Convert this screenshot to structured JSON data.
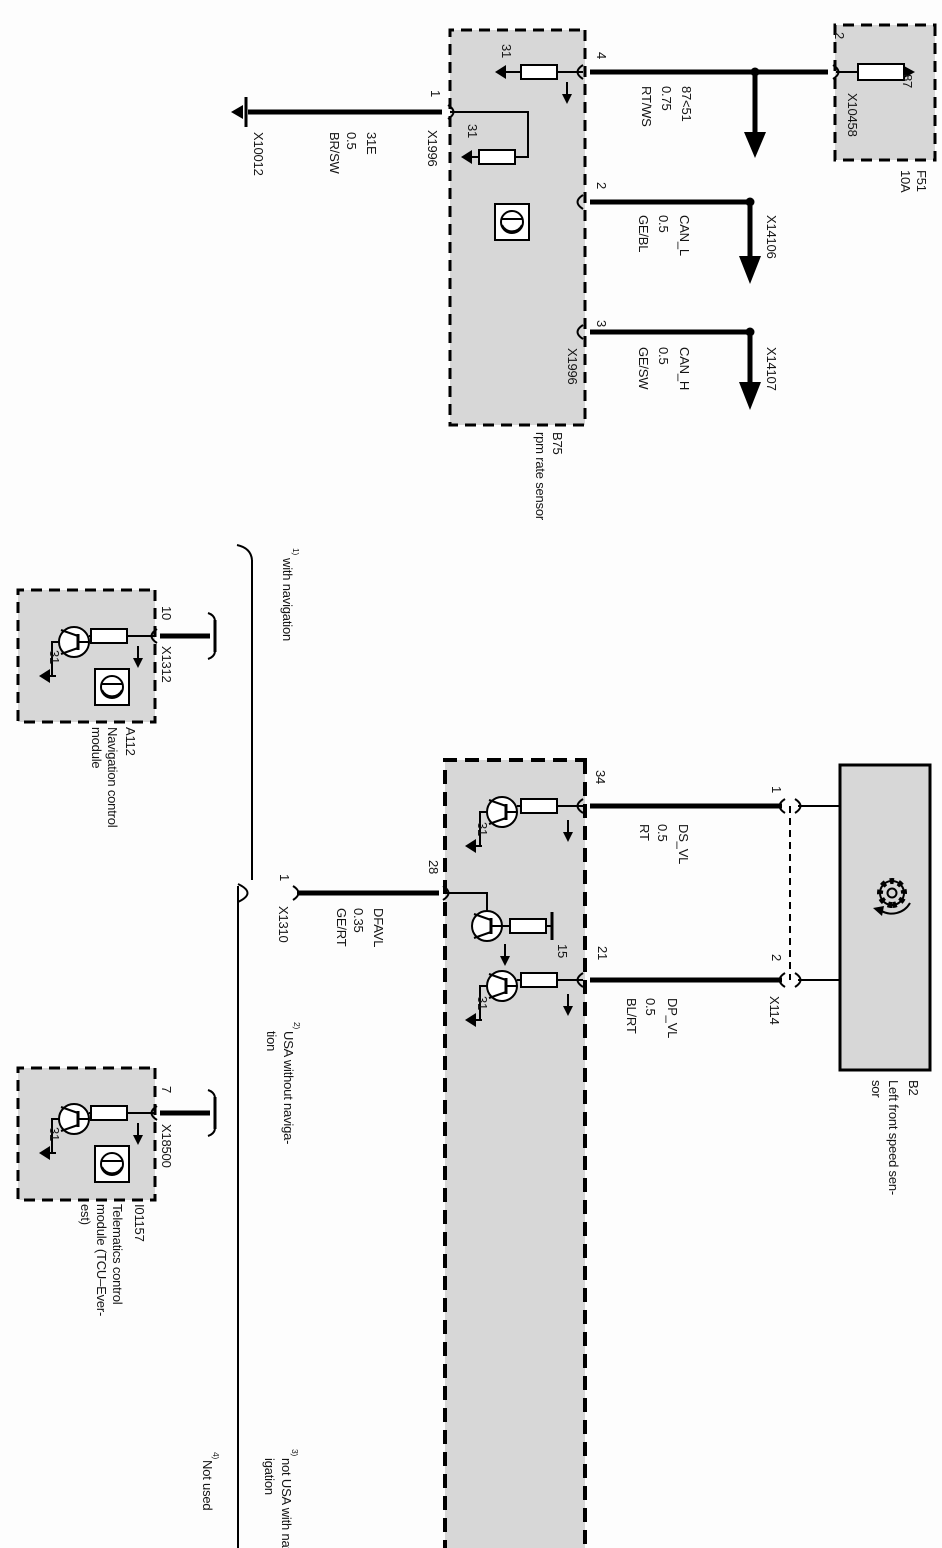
{
  "fuse": {
    "terminal_87": "87",
    "pin": "2",
    "connector": "X10458",
    "code": "F51",
    "rating": "10A"
  },
  "wire_87": {
    "name": "87<51",
    "gauge": "0.75",
    "color": "RT/WS"
  },
  "can_l": {
    "name": "CAN_L",
    "gauge": "0.5",
    "color": "GE/BL",
    "connector": "X14106"
  },
  "can_h": {
    "name": "CAN_H",
    "gauge": "0.5",
    "color": "GE/SW",
    "connector": "X14107"
  },
  "wire_31e": {
    "name": "31E",
    "gauge": "0.5",
    "color": "BR/SW",
    "terminal": "X10012"
  },
  "b75": {
    "pin4": "4",
    "pin2": "2",
    "pin3": "3",
    "pin1": "1",
    "connector_top": "X1996",
    "connector_bottom": "X1996",
    "ground1": "31",
    "ground2": "31",
    "code": "B75",
    "name": "rpm rate sensor"
  },
  "b2": {
    "code": "B2",
    "name1": "Left front speed sen-",
    "name2": "sor",
    "pin1": "1",
    "pin2": "2",
    "connector": "X114"
  },
  "wire_ds": {
    "name": "DS_VL",
    "gauge": "0.5",
    "color": "RT"
  },
  "wire_dp": {
    "name": "DP_VL",
    "gauge": "0.5",
    "color": "BL/RT"
  },
  "wire_dfa": {
    "name": "DFAVL",
    "gauge": "0.35",
    "color": "GE/RT"
  },
  "module": {
    "pin34": "34",
    "pin21": "21",
    "pin28": "28",
    "term15": "15",
    "ground1": "31",
    "ground2": "31"
  },
  "x1310": {
    "pin": "1",
    "name": "X1310"
  },
  "a112": {
    "pin": "10",
    "connector": "X1312",
    "ground": "31",
    "code": "A112",
    "name1": "Navigation control",
    "name2": "module"
  },
  "tcu": {
    "pin": "7",
    "connector": "X18500",
    "ground": "31",
    "code": "I01157",
    "name1": "Telematics control",
    "name2": "module (TCU–Ever-",
    "name3": "est)"
  },
  "notes": {
    "with_nav_sup": "1)",
    "with_nav": "with navigation",
    "usa_sup": "2)",
    "usa1": "USA without naviga-",
    "usa2": "tion",
    "not_usa_sup": "3)",
    "not_usa1": "not USA with nav-",
    "not_usa2": "igation",
    "not_used_sup": "4)",
    "not_used": "Not used"
  }
}
